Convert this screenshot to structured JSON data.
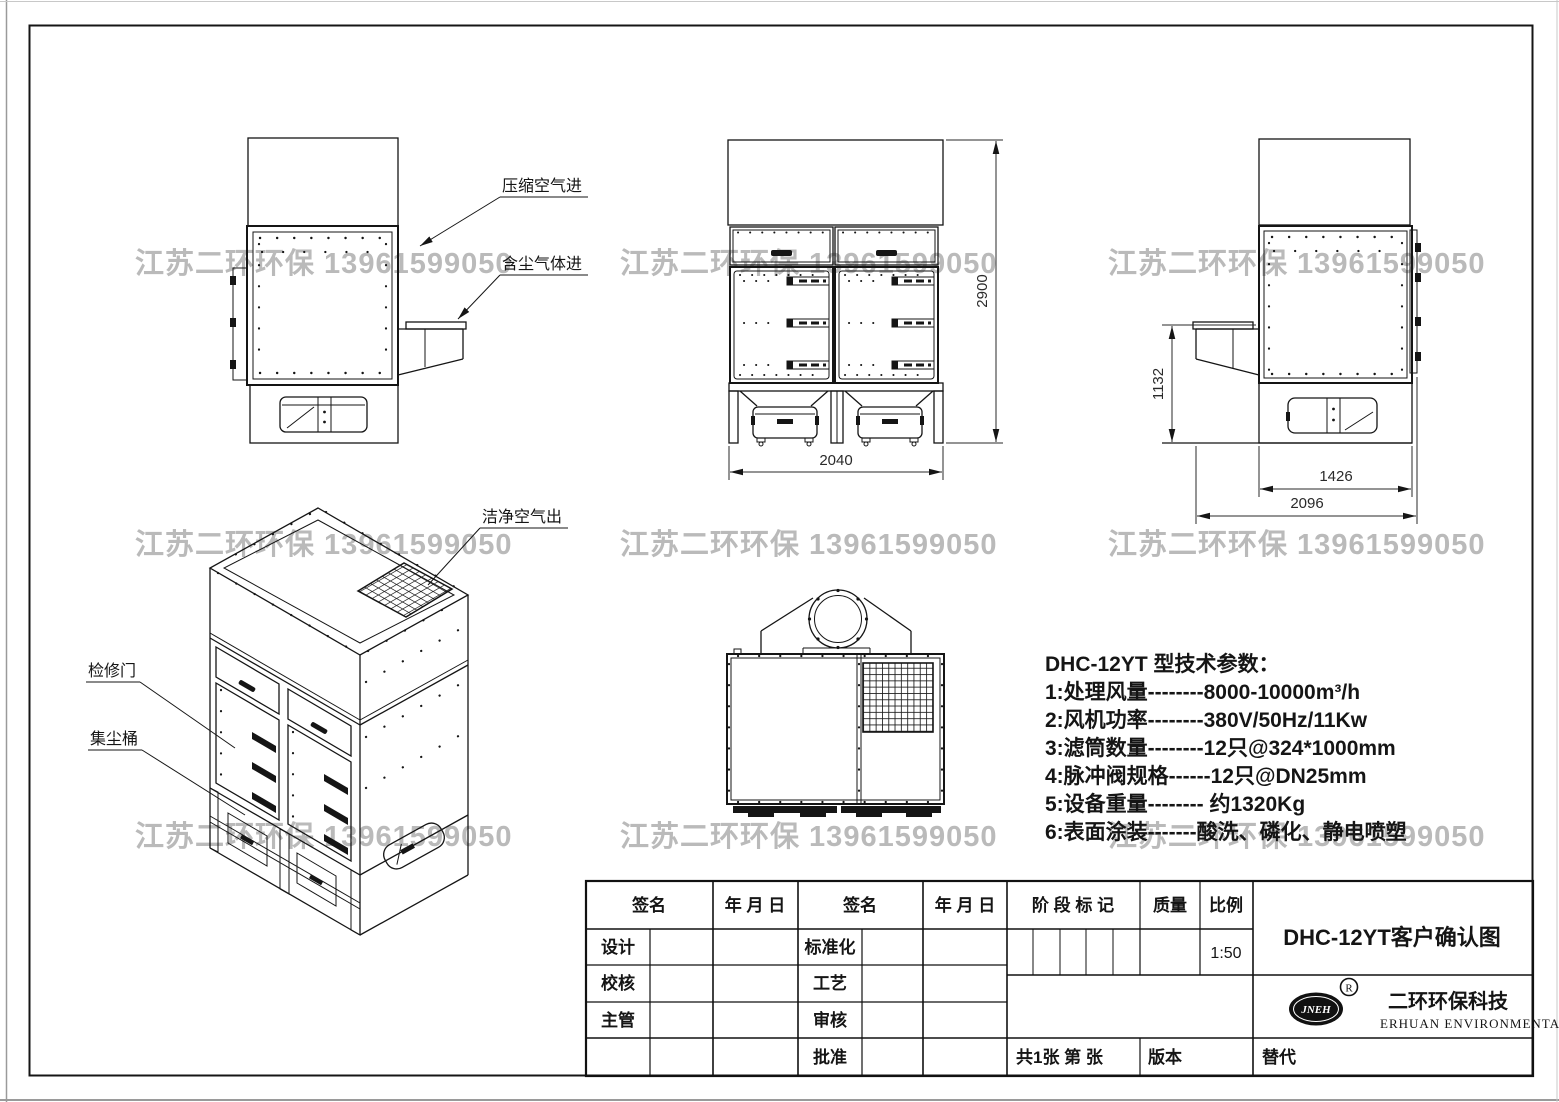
{
  "watermark": {
    "text": "江苏二环环保 13961599050"
  },
  "views": {
    "side_left": {
      "labels": {
        "compressed_air_in": "压缩空气进",
        "dusty_gas_in": "含尘气体进"
      }
    },
    "front": {
      "dims": {
        "height": "2900",
        "width": "2040"
      }
    },
    "side_right": {
      "dims": {
        "inlet_height": "1132",
        "body_depth": "1426",
        "total_depth": "2096"
      }
    },
    "isometric": {
      "labels": {
        "clean_air_out": "洁净空气出",
        "access_door": "检修门",
        "dust_barrel": "集尘桶"
      }
    }
  },
  "parameters": {
    "title": "DHC-12YT 型技术参数：",
    "lines": [
      "1:处理风量--------8000-10000m³/h",
      "2:风机功率--------380V/50Hz/11Kw",
      "3:滤筒数量--------12只@324*1000mm",
      "4:脉冲阀规格------12只@DN25mm",
      "5:设备重量-------- 约1320Kg",
      "6:表面涂装-------酸洗、磷化、静电喷塑"
    ]
  },
  "title_block": {
    "sign_label": "签名",
    "date_label": "年 月 日",
    "stage_label": "阶 段 标 记",
    "quality_label": "质量",
    "scale_label": "比例",
    "scale_value": "1:50",
    "rows_left": [
      "设计",
      "校核",
      "主管"
    ],
    "rows_mid": [
      "标准化",
      "工艺",
      "审核",
      "批准"
    ],
    "drawing_title": "DHC-12YT客户确认图",
    "sheet_info": "共1张  第  张",
    "version_label": "版本",
    "replace_label": "替代",
    "company_cn": "二环环保科技",
    "company_en": "ERHUAN ENVIRONMENTAL",
    "logo_text": "JNEH",
    "registered_mark": "R"
  }
}
